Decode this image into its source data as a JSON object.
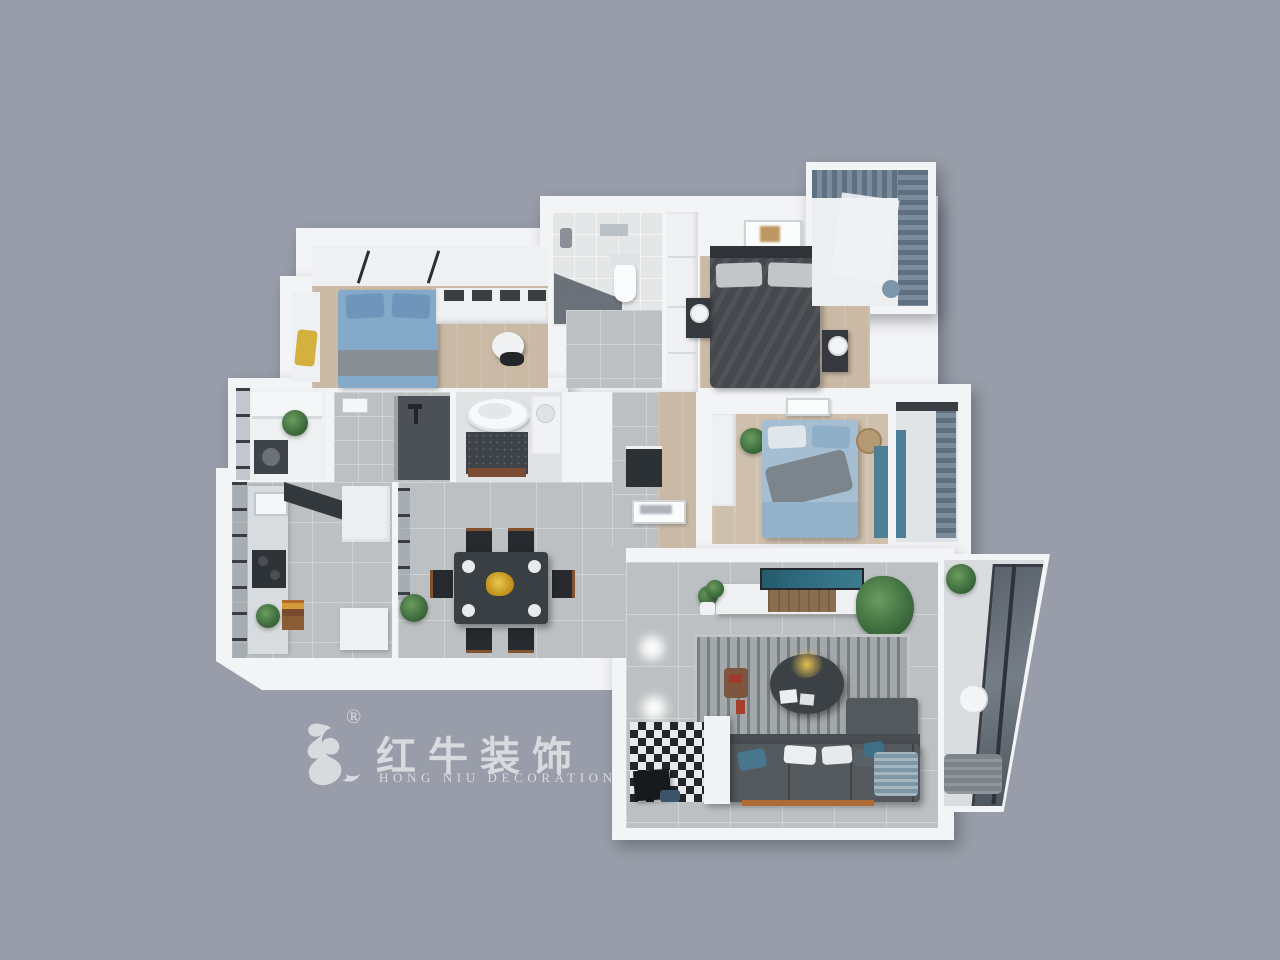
{
  "scene": {
    "description": "3D top-down render of a three-bedroom apartment floor plan on a gray backdrop",
    "background": "#989da9"
  },
  "watermark": {
    "registered": "®",
    "brand_cn": "红牛装饰",
    "brand_en": "HONG NIU DECORATION"
  },
  "colors": {
    "bg": "#989da9",
    "wall": "#f3f4f6",
    "wood": "#c9b9a5",
    "wood2": "#cfc0ad",
    "tile": "#bcc0c2",
    "rug": "#a3a8aa",
    "dark-furn": "#35393d",
    "dark-bed": "#45494e",
    "headboard": "#303439",
    "blue-bed": "#85a9c9",
    "blue-bed2": "#a6bed2",
    "blue-pillow": "#6f96ba",
    "teal-wall": "#4d7f96",
    "tv-screen": "#2f6b7e",
    "sofa": "#54595e",
    "sofa-dark": "#484d52",
    "dining-table": "#3a3f44",
    "chair": "#26292d",
    "chair-wood": "#80522e",
    "gold": "#cfa12f",
    "yellow-cushion": "#d4b13e",
    "frame": "#3a3e44",
    "mosaic": "#3d4348",
    "wood-mat": "#7b4b34",
    "orange-base": "#b06a33",
    "steel": "#2e3337",
    "logo": "#d8dade"
  },
  "rooms": [
    "study-bedroom",
    "guest-toilet",
    "wardrobe-corridor",
    "master-bedroom",
    "master-balcony",
    "utility-balcony",
    "shower-bathroom",
    "tub-bathroom",
    "kitchen",
    "dining-room",
    "hallway",
    "second-bedroom",
    "second-bedroom-balcony",
    "living-room",
    "entry-hall",
    "living-balcony"
  ]
}
